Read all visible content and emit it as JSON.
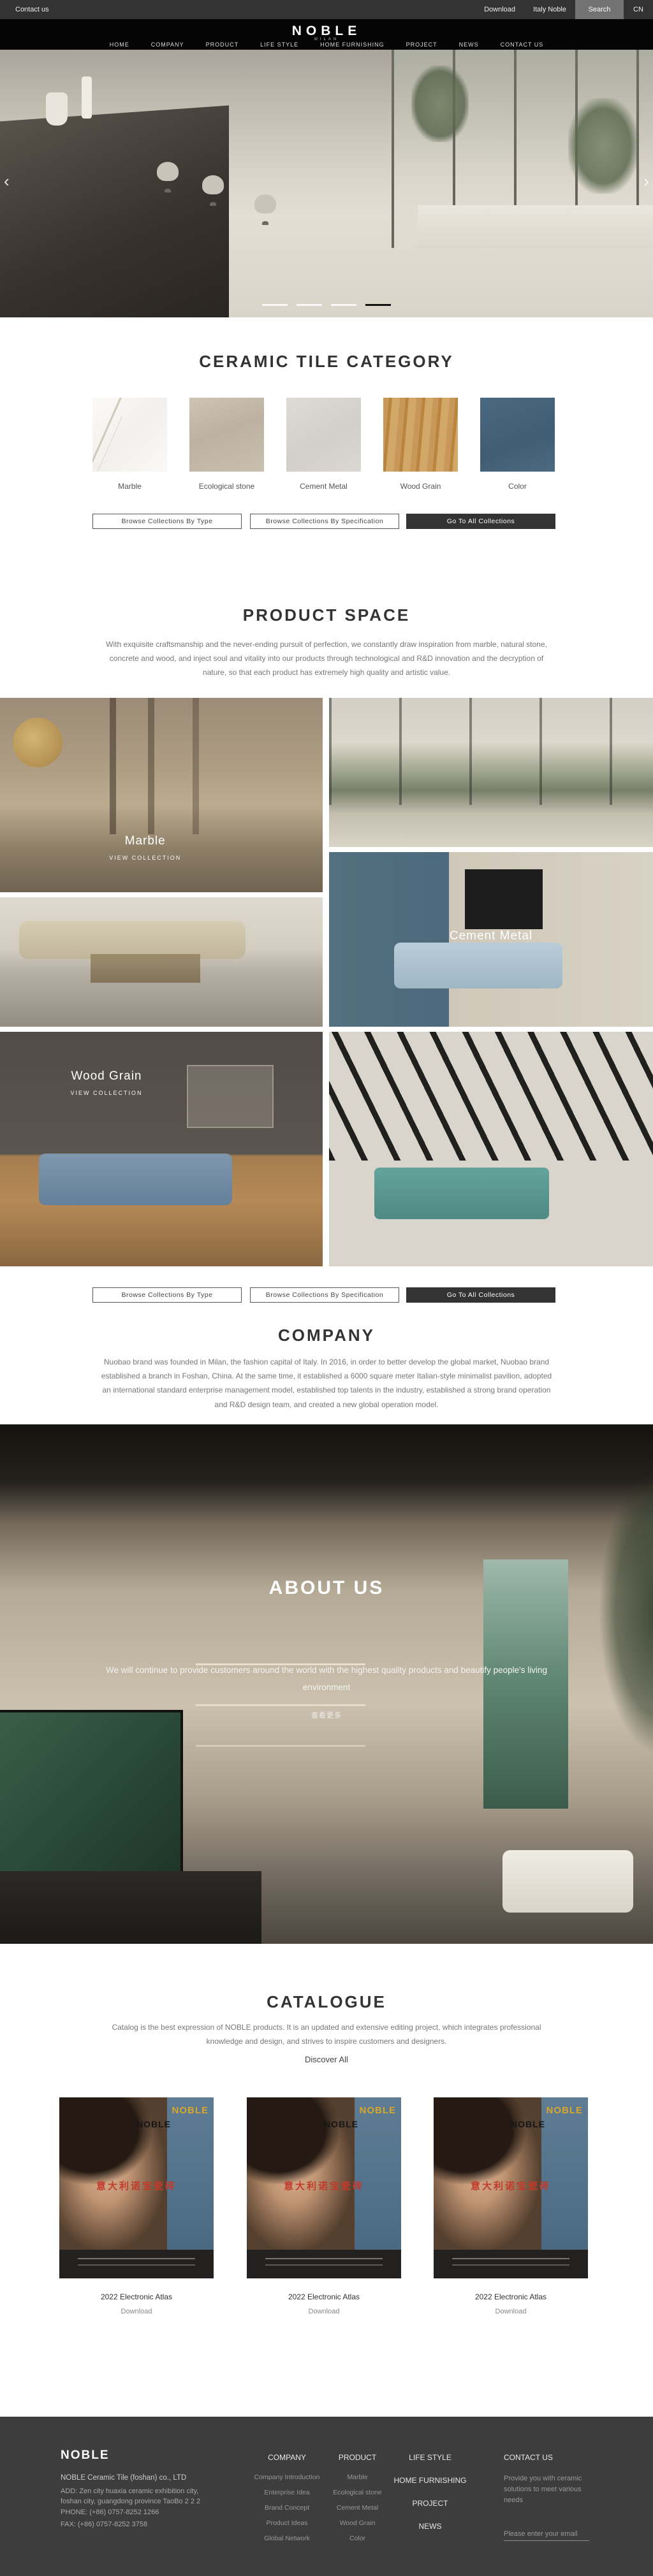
{
  "topbar": {
    "contact_us": "Contact us",
    "download": "Download",
    "italy_noble": "Italy Noble",
    "search": "Search",
    "lang": "CN"
  },
  "header": {
    "logo": "NOBLE",
    "logo_sub": "MILAN",
    "nav": [
      "HOME",
      "COMPANY",
      "PRODUCT",
      "LIFE STYLE",
      "HOME FURNISHING",
      "PROJECT",
      "NEWS",
      "CONTACT US"
    ]
  },
  "hero": {
    "slide_count": 4,
    "active_slide": 4,
    "prev": "‹",
    "next": "›"
  },
  "category": {
    "title": "CERAMIC TILE CATEGORY",
    "items": [
      {
        "label": "Marble",
        "color": "#f6f5f2"
      },
      {
        "label": "Ecological stone",
        "color": "#c4baab"
      },
      {
        "label": "Cement Metal",
        "color": "#d8d5ce"
      },
      {
        "label": "Wood Grain",
        "color": "#c79857"
      },
      {
        "label": "Color",
        "color": "#46627a"
      }
    ]
  },
  "collection_buttons": {
    "by_type": "Browse Collections By Type",
    "by_spec": "Browse Collections By Specification",
    "all": "Go To All Collections"
  },
  "product_space": {
    "title": "PRODUCT SPACE",
    "description": "With exquisite craftsmanship and the never-ending pursuit of perfection, we constantly draw inspiration from marble, natural stone, concrete and wood, and inject soul and vitality into our products through technological and R&D innovation and the decryption of nature, so that each product has extremely high quality and artistic value.",
    "tiles": [
      {
        "label": "Marble",
        "cta": "VIEW COLLECTION"
      },
      {
        "label": "Cement Metal",
        "cta": "VIEW COLLECTION"
      },
      {
        "label": "Wood Grain",
        "cta": "VIEW COLLECTION"
      }
    ]
  },
  "company": {
    "title": "COMPANY",
    "description": "Nuobao brand was founded in Milan, the fashion capital of Italy. In 2016, in order to better develop the global market, Nuobao brand established a branch in Foshan, China. At the same time, it established a 6000 square meter Italian-style minimalist pavilion, adopted an international standard enterprise management model, established top talents in the industry, established a strong brand operation and R&D design team, and created a new global operation model."
  },
  "about": {
    "title": "ABOUT US",
    "description": "We will continue to provide customers around the world with the highest quality products and beautify people's living environment",
    "more": "查看更多"
  },
  "catalogue": {
    "title": "CATALOGUE",
    "description": "Catalog is the best expression of NOBLE products. It is an updated and extensive editing project, which integrates professional knowledge and design, and strives to inspire customers and designers.",
    "discover": "Discover All",
    "card_art": {
      "brand_gold": "NOBLE",
      "brand_black": "NOBLE",
      "cn_title": "意大利诺宝瓷砖"
    },
    "cards": [
      {
        "title": "2022 Electronic Atlas",
        "action": "Download"
      },
      {
        "title": "2022 Electronic Atlas",
        "action": "Download"
      },
      {
        "title": "2022 Electronic Atlas",
        "action": "Download"
      }
    ]
  },
  "footer": {
    "logo": "NOBLE",
    "company_name": "NOBLE Ceramic Tile (foshan) co., LTD",
    "address": "ADD:  Zen city huaxia ceramic exhibition city, foshan city, guangdong province TaoBo 2 2 2",
    "phone": "PHONE:   (+86)  0757-8252 1266",
    "fax": "FAX:   (+86)  0757-8252 3758",
    "columns": [
      {
        "title": "COMPANY",
        "items": [
          "Company Introduction",
          "Enterprise Idea",
          "Brand Concept",
          "Product Ideas",
          "Global Network"
        ]
      },
      {
        "title": "PRODUCT",
        "items": [
          "Marble",
          "Ecological stone",
          "Cement Metal",
          "Wood Grain",
          "Color"
        ]
      }
    ],
    "section_links": [
      "LIFE STYLE",
      "HOME FURNISHING",
      "PROJECT",
      "NEWS"
    ],
    "contact": {
      "title": "CONTACT US",
      "text": "Provide you with ceramic solutions to meet various needs",
      "email_placeholder": "Please enter your email"
    }
  }
}
